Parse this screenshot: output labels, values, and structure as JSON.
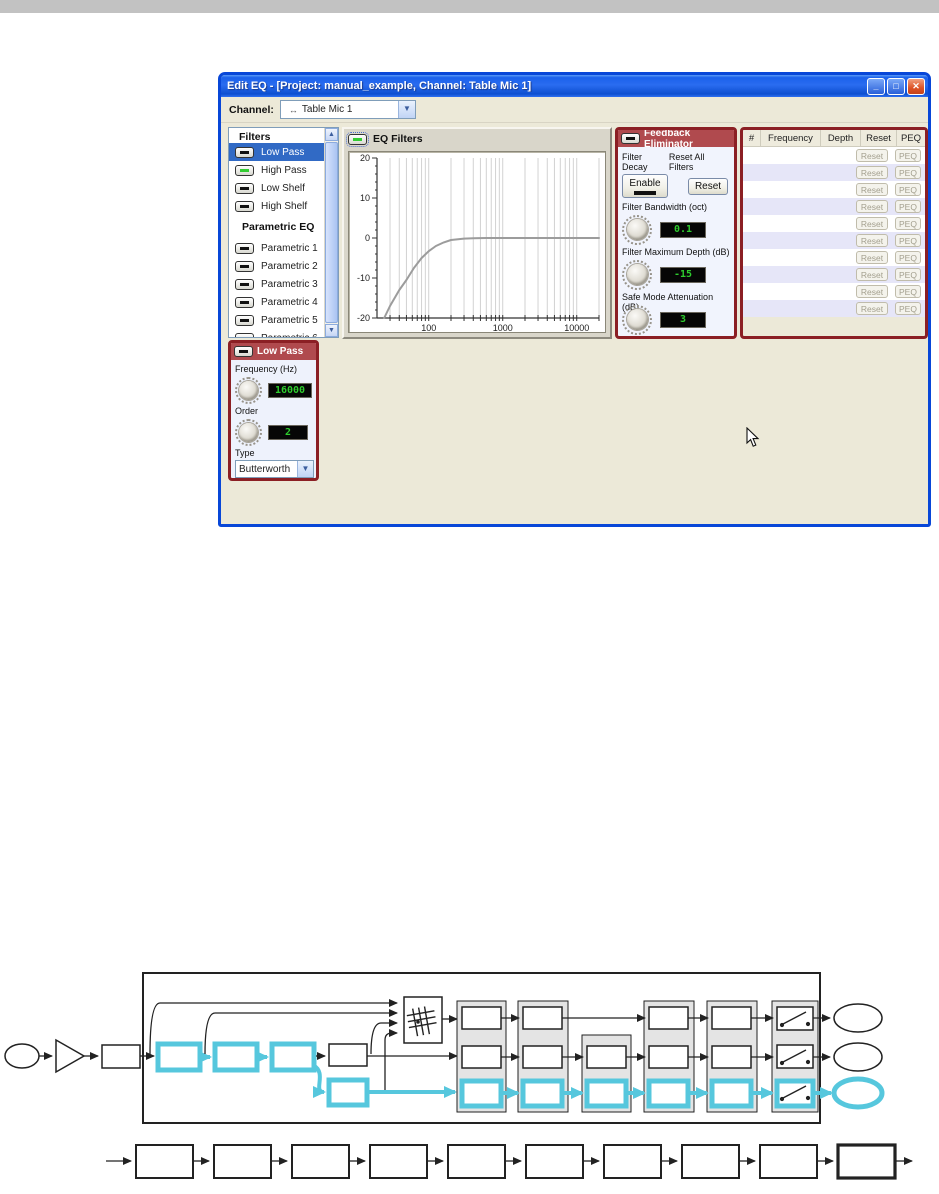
{
  "page": {
    "top_bar_color": "#c2c2c2"
  },
  "window": {
    "title": "Edit EQ - [Project: manual_example, Channel: Table Mic 1]",
    "titlebar_buttons": {
      "minimize": "_",
      "maximize": "□",
      "close": "✕"
    },
    "toolbar": {
      "channel_label": "Channel:",
      "channel_icon": "↔",
      "channel_value": "Table Mic 1"
    }
  },
  "filters_panel": {
    "header": "Filters",
    "items": [
      {
        "label": "Low Pass",
        "selected": true,
        "led_color": "#111111"
      },
      {
        "label": "High Pass",
        "selected": false,
        "led_color": "#33cc33"
      },
      {
        "label": "Low Shelf",
        "selected": false,
        "led_color": "#111111"
      },
      {
        "label": "High Shelf",
        "selected": false,
        "led_color": "#111111"
      }
    ],
    "parametric_header": "Parametric EQ",
    "parametric_items": [
      {
        "label": "Parametric 1"
      },
      {
        "label": "Parametric 2"
      },
      {
        "label": "Parametric 3"
      },
      {
        "label": "Parametric 4"
      },
      {
        "label": "Parametric 5"
      },
      {
        "label": "Parametric 6"
      }
    ]
  },
  "eq_graph": {
    "title": "EQ Filters",
    "chart_data": {
      "type": "line",
      "x_scale": "log",
      "xlim": [
        20,
        20000
      ],
      "ylim": [
        -20,
        20
      ],
      "y_tick_values": [
        20,
        10,
        0,
        -10,
        -20
      ],
      "y_tick_labels": [
        "20",
        "10",
        "0",
        "-10",
        "-20"
      ],
      "x_tick_values": [
        100,
        1000,
        10000
      ],
      "x_tick_labels": [
        "100",
        "1000",
        "10000"
      ],
      "grid": true,
      "series": [
        {
          "name": "high-pass-response",
          "color": "#9c9c9c",
          "points": [
            [
              25,
              -20
            ],
            [
              30,
              -17
            ],
            [
              40,
              -13
            ],
            [
              50,
              -10.5
            ],
            [
              63,
              -7.5
            ],
            [
              80,
              -5
            ],
            [
              100,
              -3.3
            ],
            [
              125,
              -2
            ],
            [
              160,
              -1.1
            ],
            [
              200,
              -0.5
            ],
            [
              300,
              -0.15
            ],
            [
              400,
              -0.05
            ],
            [
              600,
              0
            ],
            [
              20000,
              0
            ]
          ]
        }
      ]
    }
  },
  "feedback_panel": {
    "title": "Feedback Eliminator",
    "filter_decay_label": "Filter Decay",
    "reset_all_label": "Reset All Filters",
    "enable_button": "Enable",
    "reset_button": "Reset",
    "bandwidth_label": "Filter Bandwidth (oct)",
    "bandwidth_value": "0.1",
    "max_depth_label": "Filter Maximum Depth (dB)",
    "max_depth_value": "-15",
    "safe_mode_label": "Safe Mode Attenuation (dB)",
    "safe_mode_value": "3",
    "meter": {
      "counter_value": "0",
      "scale_min_label": "0",
      "scale_max_label": "+20",
      "segments": 11
    }
  },
  "peq_table": {
    "columns": [
      "#",
      "Frequency",
      "Depth",
      "Reset",
      "PEQ"
    ],
    "row_count": 10,
    "reset_button": "Reset",
    "peq_button": "PEQ"
  },
  "low_pass_panel": {
    "title": "Low Pass",
    "frequency_label": "Frequency (Hz)",
    "frequency_value": "16000",
    "order_label": "Order",
    "order_value": "2",
    "type_label": "Type",
    "type_value": "Butterworth"
  },
  "colors": {
    "panel_border": "#8b1f24",
    "panel_header_bg": "#b04a4e",
    "selection_bg": "#316ac5",
    "lcd_text": "#2ecc2e",
    "diagram_highlight": "#56c7dd",
    "titlebar_blue": "#0a57e4",
    "client_bg": "#ece9d8"
  }
}
